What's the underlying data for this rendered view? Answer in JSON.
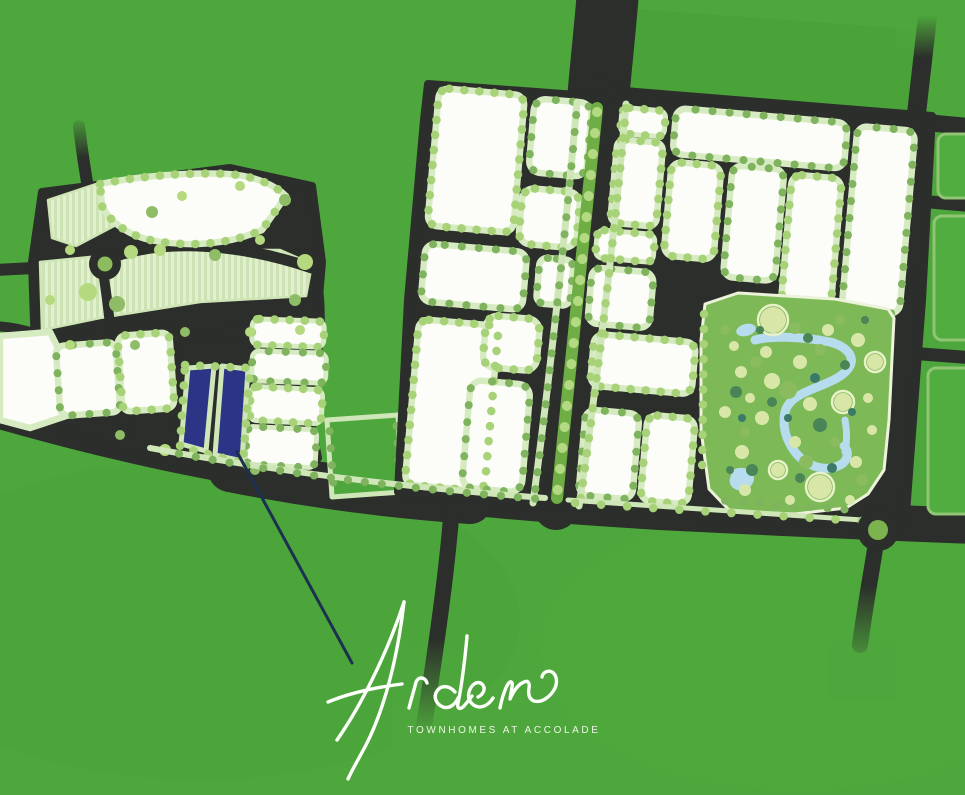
{
  "brand": {
    "name": "Arden",
    "tagline": "TOWNHOMES AT ACCOLADE"
  },
  "map": {
    "description": "Illustrated master-plan community site map with green fields, dark roads, white residential blocks lined with trees, a central park with a winding stream, and the Arden townhomes parcels highlighted in navy blue",
    "highlighted_site": {
      "label": "Arden Townhomes at Accolade site parcels",
      "color": "#2c3585"
    },
    "features": {
      "park": "Community park with trees, ponds and winding stream",
      "roundabout_west": "Roundabout in west neighbourhood",
      "roundabout_east": "Roundabout at park south-east corner",
      "boulevard": "Tree-lined boulevard with landscaped median",
      "arterial_road": "Main arterial road across the bottom",
      "future_area": "Hatched light-green future development parcels"
    },
    "palette": {
      "background_green": "#4ea73c",
      "road_charcoal": "#2b2e2a",
      "block_white": "#fcfdf9",
      "verge_green": "#d7ebc2",
      "tree_light": "#a7d278",
      "tree_dark": "#7fb35d",
      "park_green": "#7db957",
      "water_blue": "#b6dcee",
      "site_navy": "#2c3585",
      "leader_navy": "#1c3050",
      "logo_white": "#ffffff"
    }
  }
}
